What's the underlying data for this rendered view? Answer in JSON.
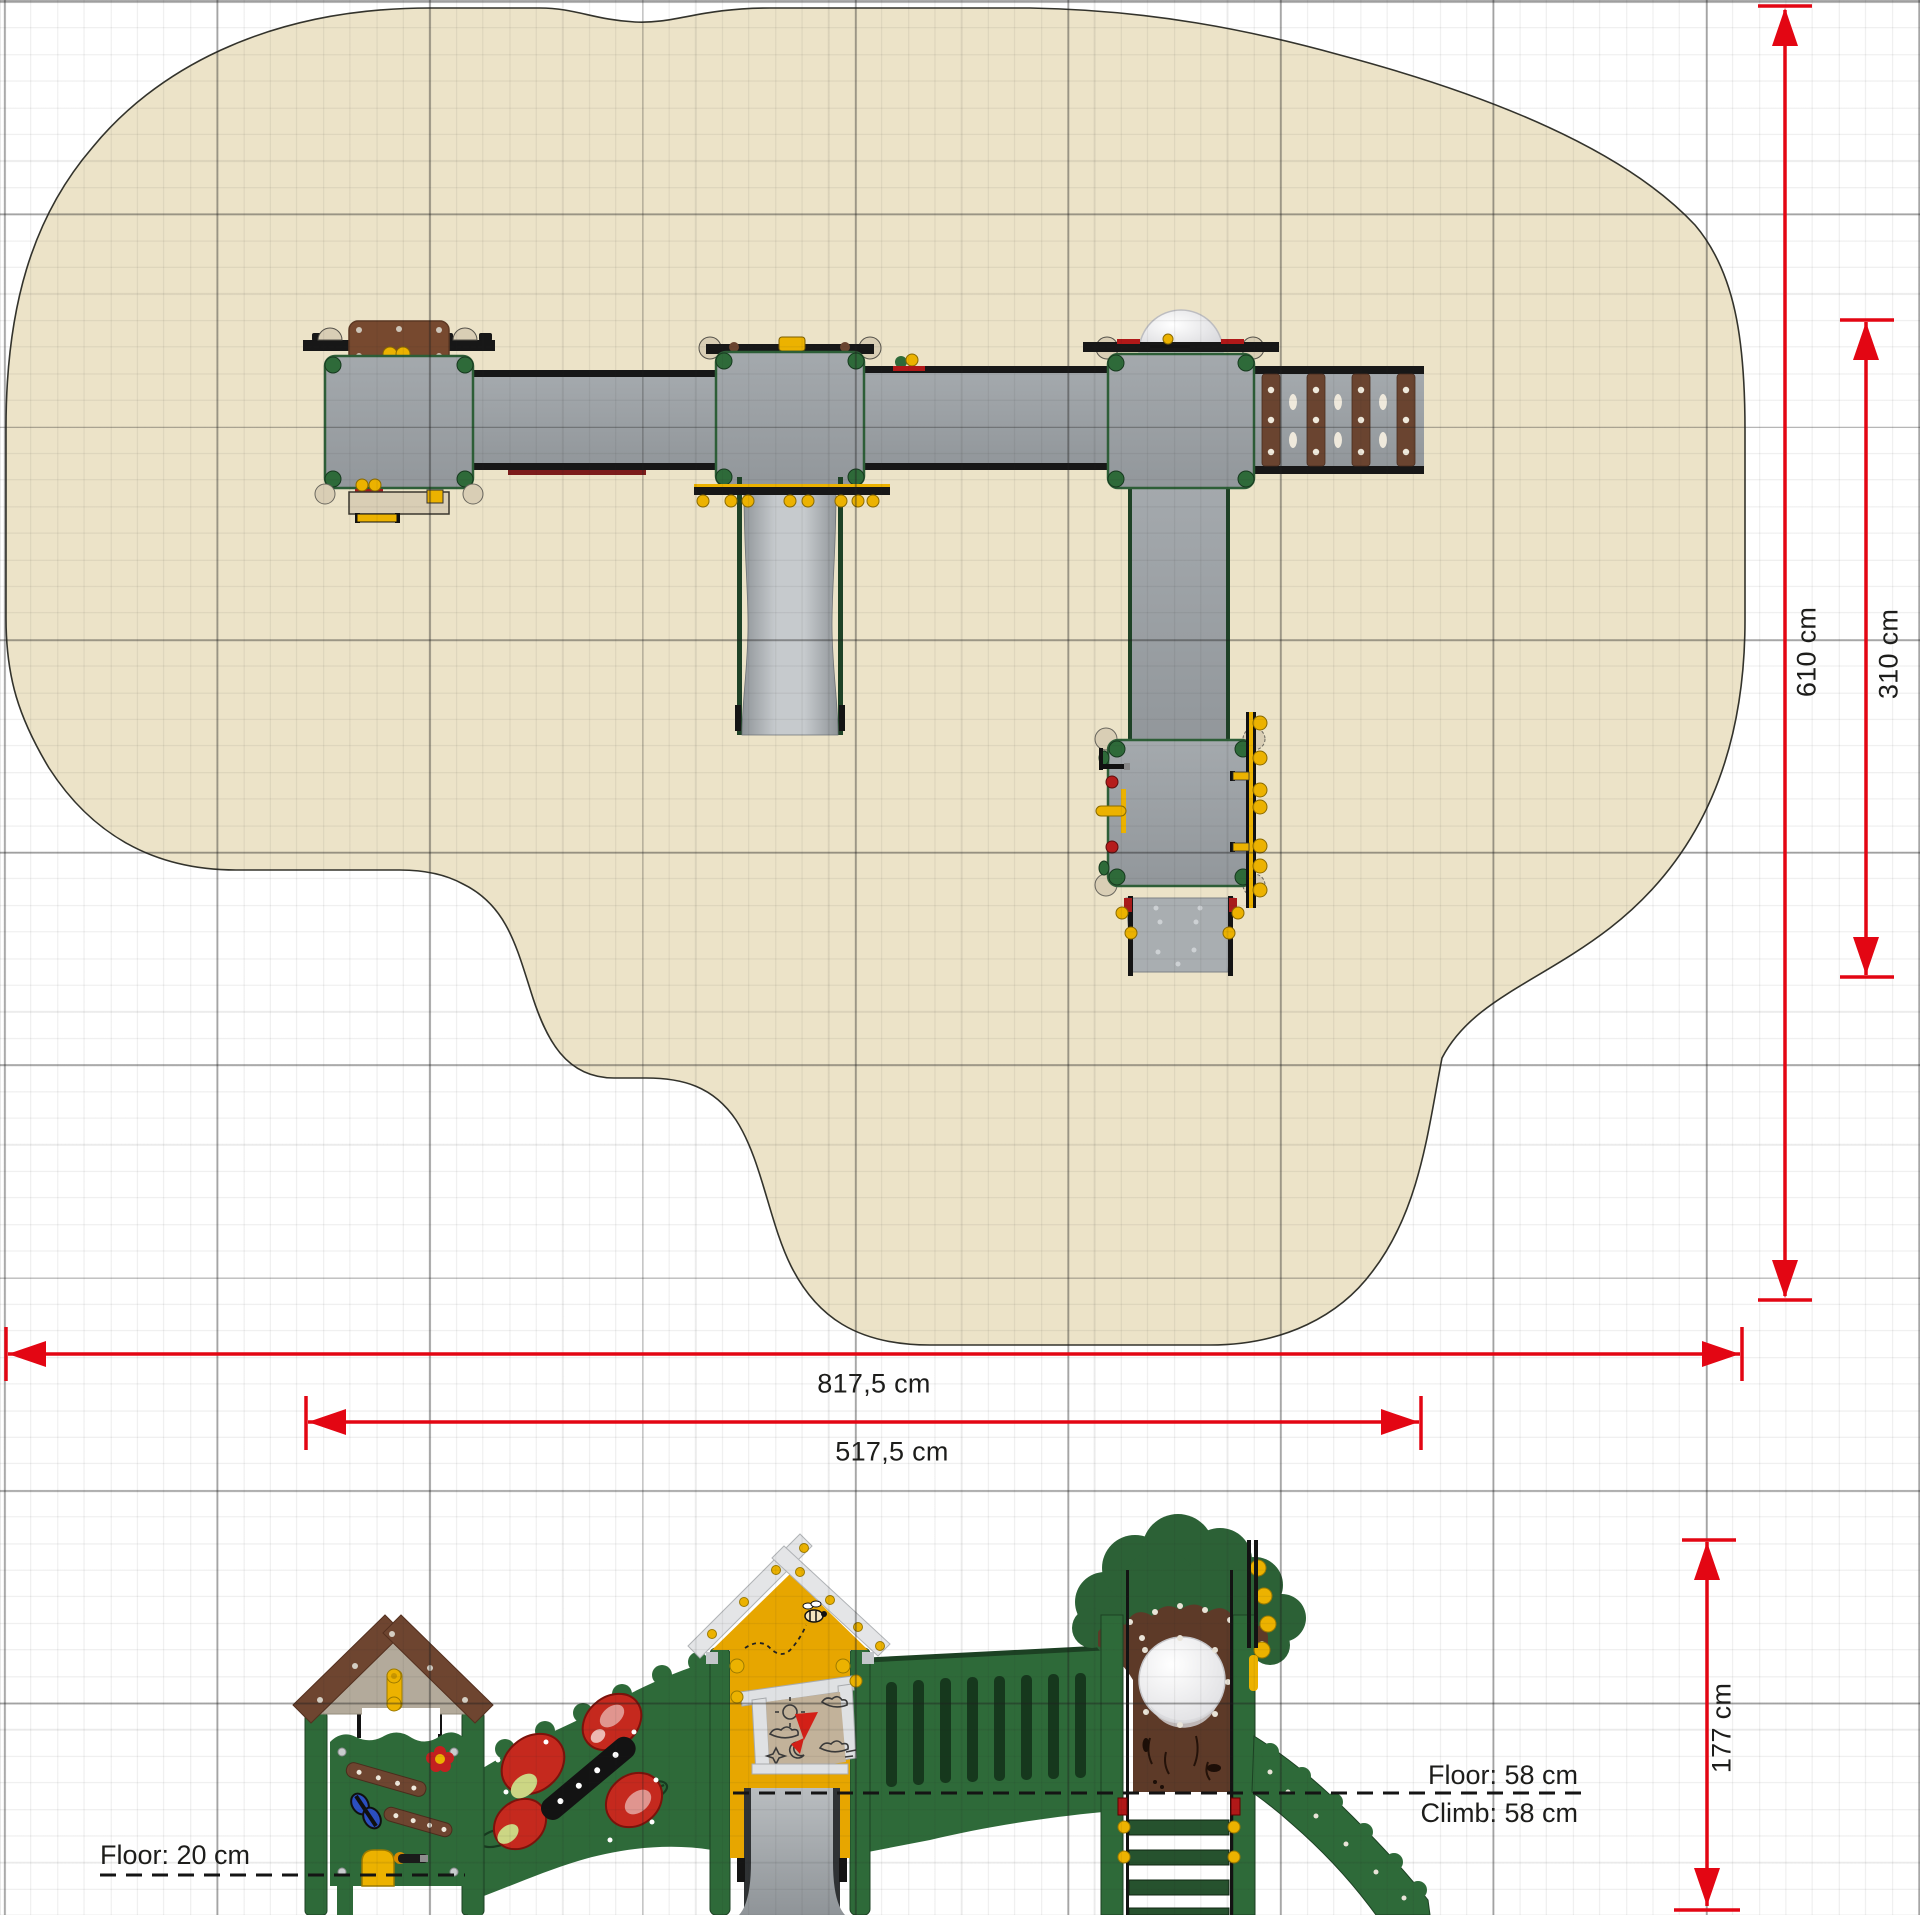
{
  "drawing": {
    "kind": "playground equipment plan and elevation",
    "units": "cm"
  },
  "plan": {
    "dim_width_total": "817,5 cm",
    "dim_width_inner": "517,5 cm",
    "dim_depth_total": "610 cm",
    "dim_depth_inner": "310 cm"
  },
  "elevation": {
    "dim_height": "177 cm",
    "floor_left": "Floor: 20 cm",
    "floor_right": "Floor: 58 cm",
    "climb_right": "Climb: 58 cm"
  },
  "colors": {
    "dimension_red": "#e30613",
    "safety_area_beige": "#ece3c8",
    "deck_gray": "#9aa0a4",
    "panel_green": "#2e6a39",
    "house_yellow": "#e7a600",
    "wood_brown": "#6e4530",
    "grid_major_gray": "#9b9b9b",
    "annotation_black": "#1d1d1b"
  }
}
